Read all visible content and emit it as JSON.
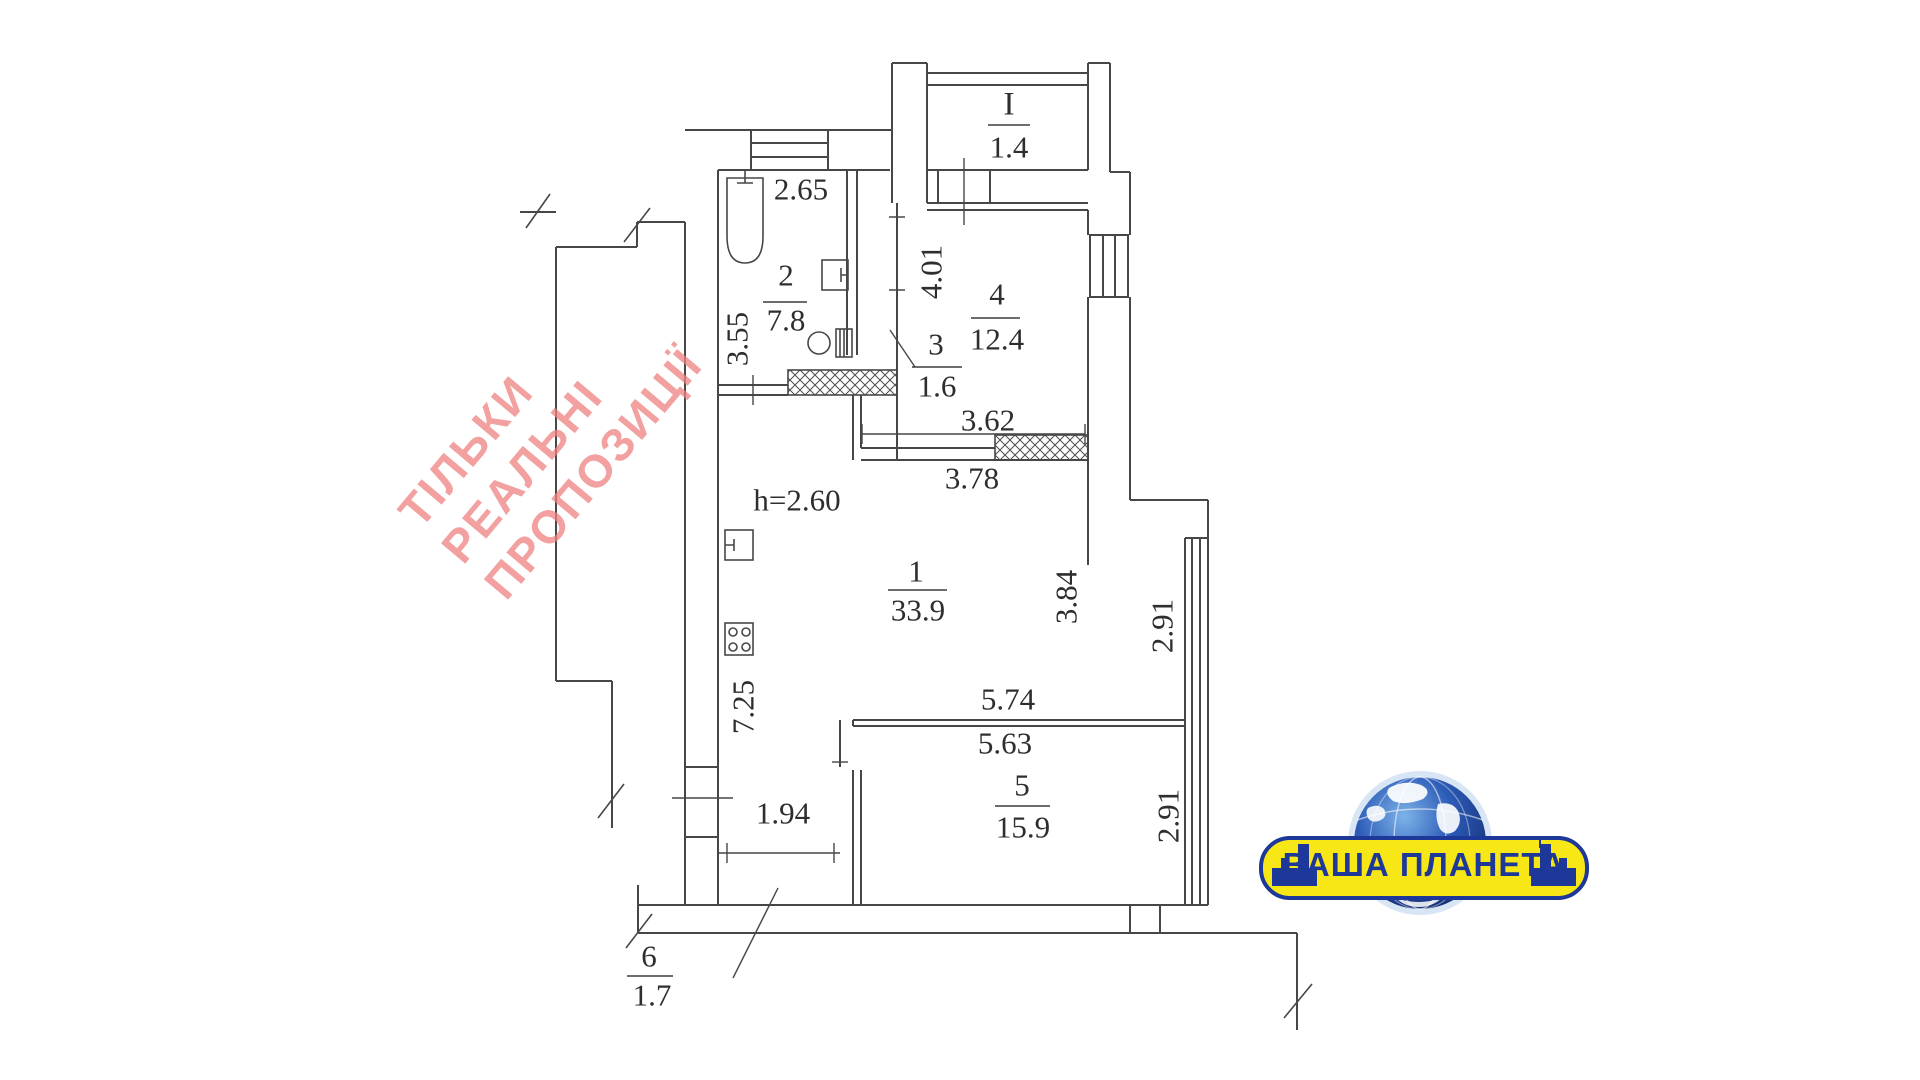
{
  "watermark": {
    "lines": [
      "ТІЛЬКИ",
      "РЕАЛЬНІ",
      "ПРОПОЗИЦІЇ"
    ],
    "color": "#ee8181"
  },
  "logo": {
    "text": "ВАША ПЛАНЕТА",
    "banner_color": "#f8e716",
    "text_color": "#1d3899",
    "globe_color": "#2d5cb8"
  },
  "plan": {
    "ceiling_height": "h=2.60",
    "rooms": {
      "balcony": {
        "number": "I",
        "area": "1.4"
      },
      "room1": {
        "number": "1",
        "area": "33.9"
      },
      "room2": {
        "number": "2",
        "area": "7.8"
      },
      "room3": {
        "number": "3",
        "area": "1.6"
      },
      "room4": {
        "number": "4",
        "area": "12.4"
      },
      "room5": {
        "number": "5",
        "area": "15.9"
      },
      "room6": {
        "number": "6",
        "area": "1.7"
      }
    },
    "dimensions": {
      "d2_65": "2.65",
      "d3_55": "3.55",
      "d4_01": "4.01",
      "d3_62": "3.62",
      "d3_78": "3.78",
      "d3_84": "3.84",
      "d2_91_upper": "2.91",
      "d2_91_lower": "2.91",
      "d5_74": "5.74",
      "d5_63": "5.63",
      "d7_25": "7.25",
      "d1_94": "1.94"
    }
  }
}
